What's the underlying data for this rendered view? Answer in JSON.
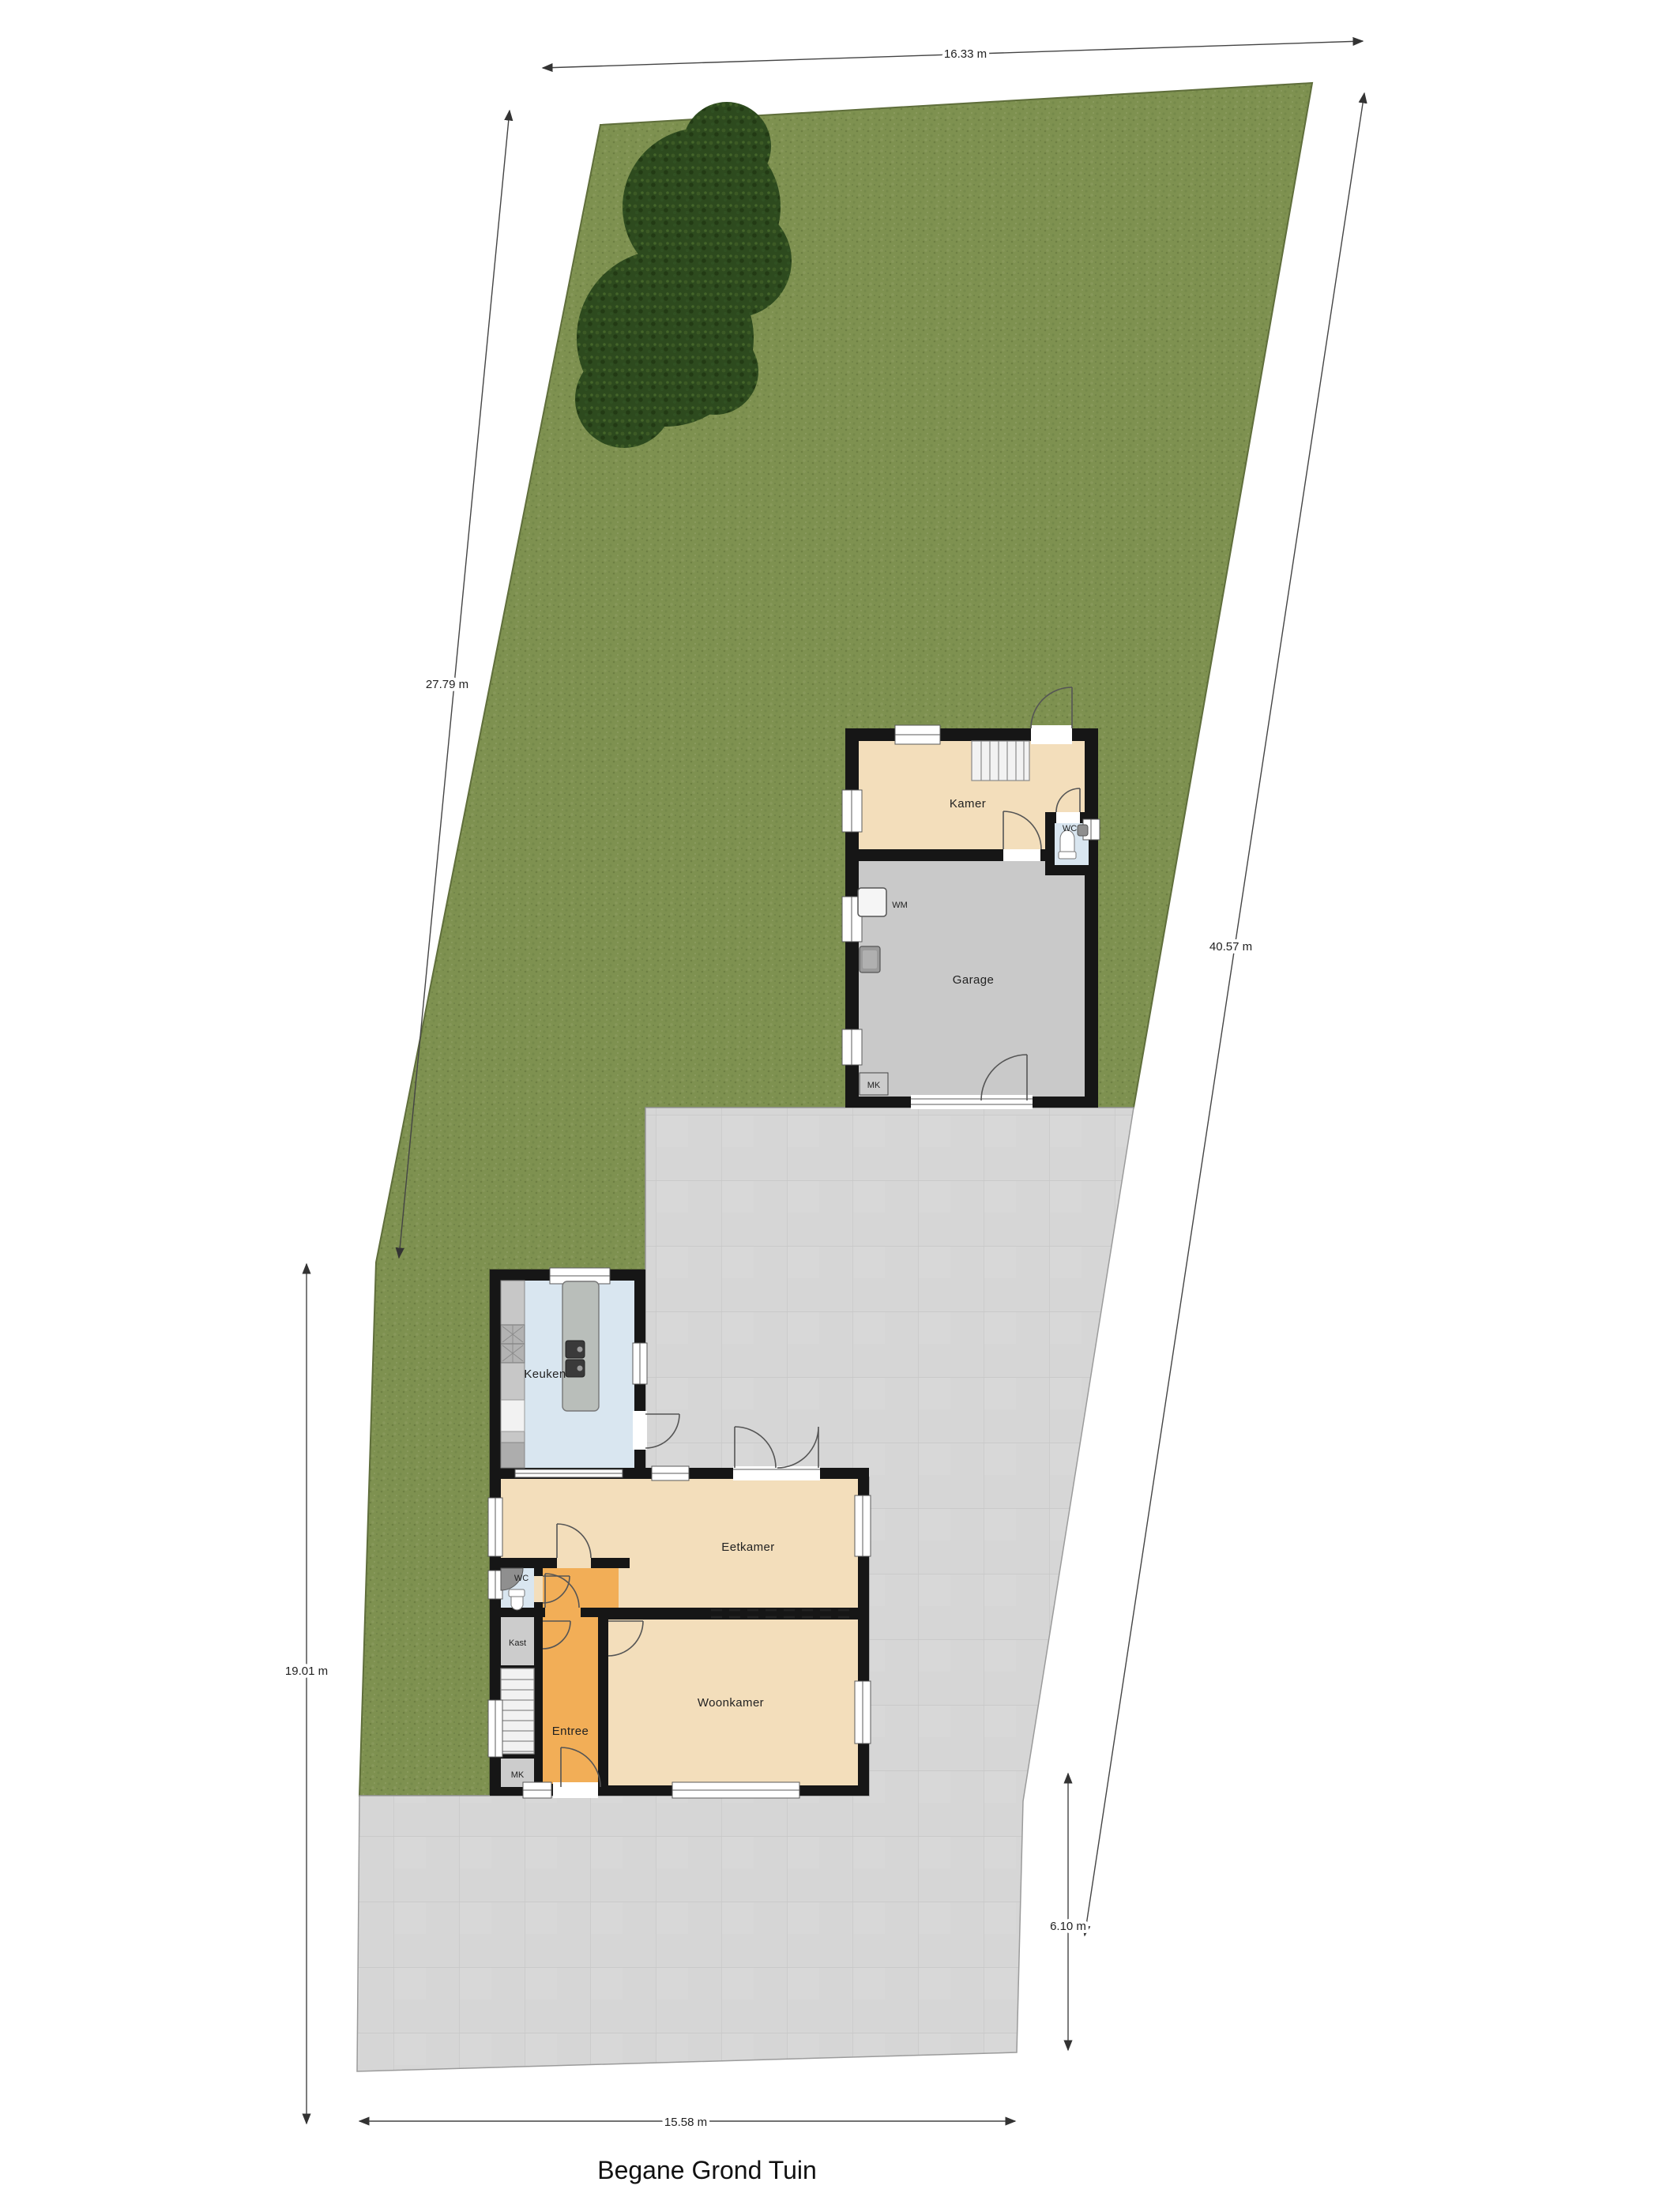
{
  "title": "Begane Grond Tuin",
  "dimensions": {
    "top": "16.33 m",
    "left_upper": "27.79 m",
    "left_lower": "19.01 m",
    "right": "40.57 m",
    "right_lower": "6.10 m",
    "bottom": "15.58 m"
  },
  "outbuilding": {
    "kamer_label": "Kamer",
    "wc_label": "WC",
    "garage_label": "Garage",
    "mk_label": "MK",
    "wm_label": "WM"
  },
  "house": {
    "keuken_label": "Keuken",
    "eetkamer_label": "Eetkamer",
    "woonkamer_label": "Woonkamer",
    "entree_label": "Entree",
    "wc_label": "WC",
    "kast_label": "Kast",
    "mk_label": "MK"
  },
  "colors": {
    "grass": "#7e9150",
    "terrace": "#d6d6d6",
    "terrace_grid": "#c7c7c7",
    "wall": "#161616",
    "beige": "#f3debb",
    "orange": "#f2ae57",
    "blue": "#d9e6f0",
    "gray_room": "#cccccc",
    "garage_gray": "#c9c9c9",
    "tree": "#2d4a1e",
    "dimension_line": "#444444"
  }
}
